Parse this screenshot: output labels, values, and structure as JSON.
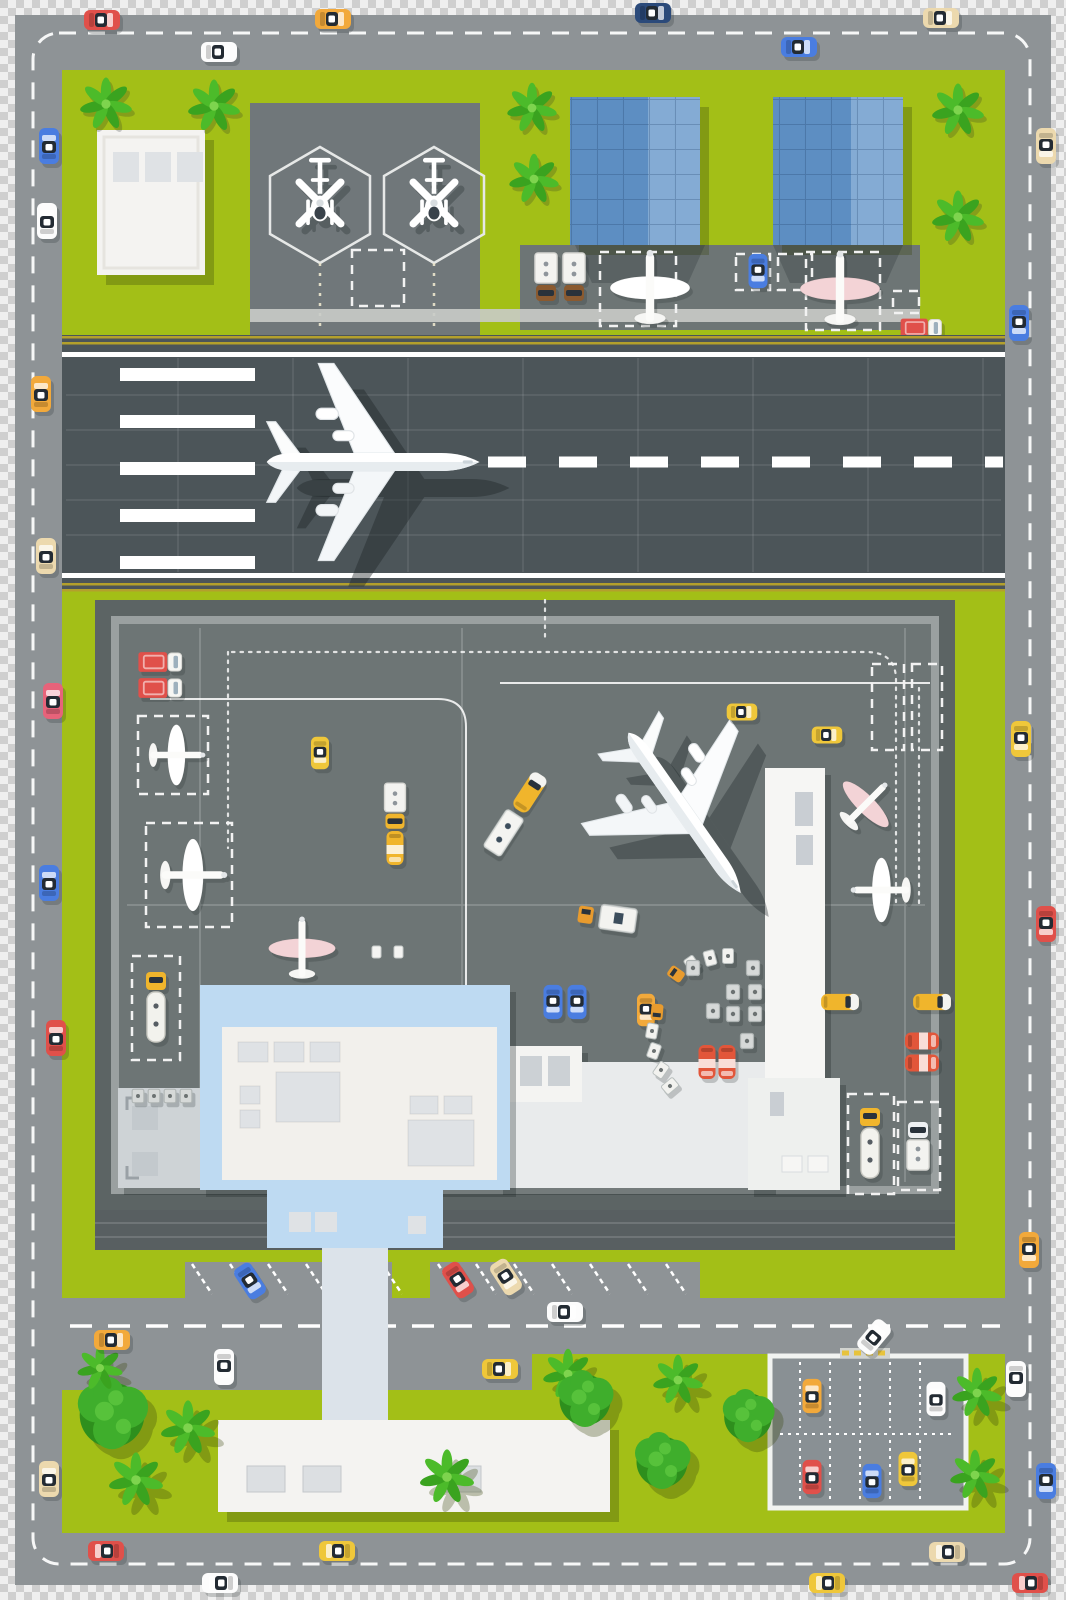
{
  "window": {
    "width": 1066,
    "height": 1600
  },
  "scene": {
    "kind": "airport-top-view-illustration",
    "areas": [
      "perimeter-ring-road",
      "heliport",
      "office-towers",
      "runway",
      "apron",
      "passenger-terminal",
      "pier",
      "access-road",
      "parking-lot",
      "lawns"
    ]
  },
  "colors": {
    "grass": "#a3bf17",
    "road": "#8e9396",
    "service_road": "#585f61",
    "runway": "#4c5559",
    "line_yellow": "#b3a02c",
    "apron_outer": "#5c6464",
    "apron_band": "#9aa0a0",
    "apron_inner": "#6d7575",
    "helipad": "#70777a",
    "walk_band": "#c9cbc8",
    "checker_a": "#cfcfcf",
    "checker_b": "#efefef",
    "terminal_roof": "#bedaf2",
    "terminal_inner": "#f2f0ec",
    "roof_box": "#dfe2e5",
    "building_white": "#f4f3f1",
    "wing_gray": "#ced3d6",
    "hall_gray": "#e9ebec",
    "pier_white": "#f6f6f4",
    "tab_gray": "#c9ced3",
    "bldg_blue": "#5d8ec2",
    "bldg_blue_light": "#84abd4",
    "parking": "#899094",
    "tree": "#3fae2c",
    "tree_dark": "#2e8f1d",
    "palm": "#4cbb2a",
    "car_red": "#e0504a",
    "car_orange": "#f2a93b",
    "car_yellow": "#efc73a",
    "car_blue": "#4a7de0",
    "car_navy": "#2b4a7a",
    "car_white": "#fcfcfc",
    "car_beige": "#ecd9ae",
    "car_pink": "#e7637a",
    "truck_brown": "#8a5a30",
    "tanker_orange": "#e2563a",
    "bus_yellow": "#f0b52c",
    "plane_white": "#ffffff",
    "plane_pink": "#f3d3d6"
  },
  "objects": {
    "aircraft": {
      "airliner_on_runway": 1,
      "airliner_on_apron": 1,
      "small_planes_parked": 7,
      "helicopters": 2
    },
    "buildings": {
      "terminal": 1,
      "pier": 1,
      "blue_office_towers": 2,
      "white_warehouse": 1,
      "service_building": 1,
      "heliport_pads": 2
    },
    "vehicles": {
      "cars": 47,
      "buses": 4,
      "box_trucks": 6,
      "fuel_tankers": 6,
      "baggage_trains": 2,
      "tug_with_trailer": 1,
      "cargo_containers": 12
    },
    "markings": {
      "runway_threshold_stripes": 5,
      "runway_centerline": "dashed",
      "ring_road_lane_line": "dashed",
      "aircraft_stands_dashed": 13
    },
    "vegetation": {
      "palm_plants": 14,
      "round_bushes": 4
    }
  }
}
